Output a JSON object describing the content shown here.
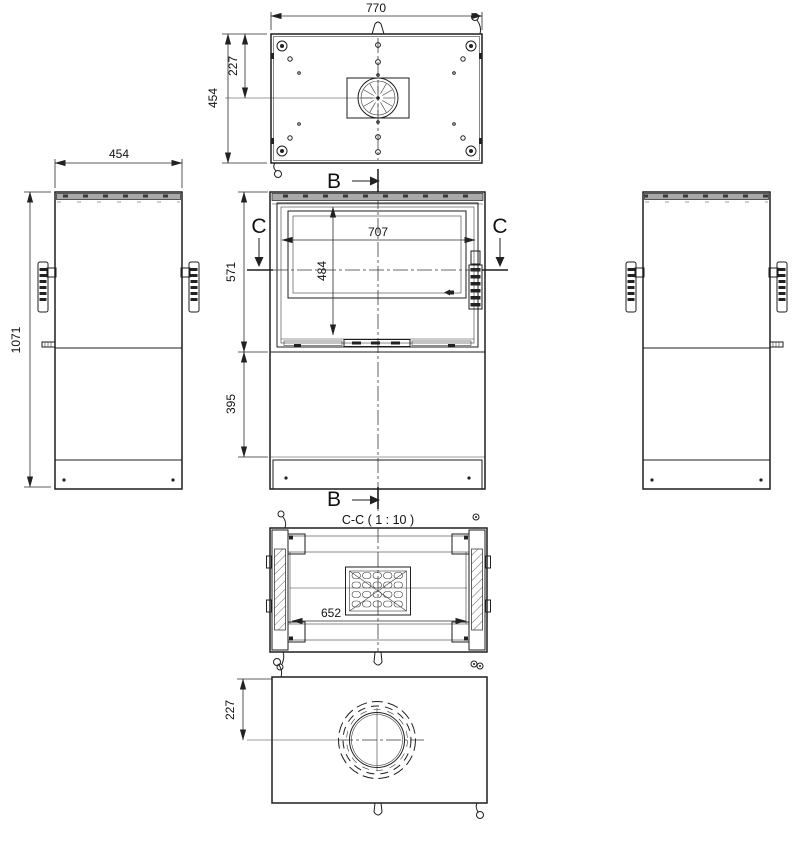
{
  "labels": {
    "section_title": "C-C ( 1 : 10 )",
    "marker_b": "B",
    "marker_c": "C"
  },
  "dimensions": {
    "top_width": "770",
    "top_depth": "454",
    "top_center_offset": "227",
    "side_width": "454",
    "overall_height": "1071",
    "glass_width": "707",
    "glass_height": "484",
    "upper_section_height": "571",
    "lower_section_height": "395",
    "section_width": "652",
    "flue_center_offset": "227"
  }
}
